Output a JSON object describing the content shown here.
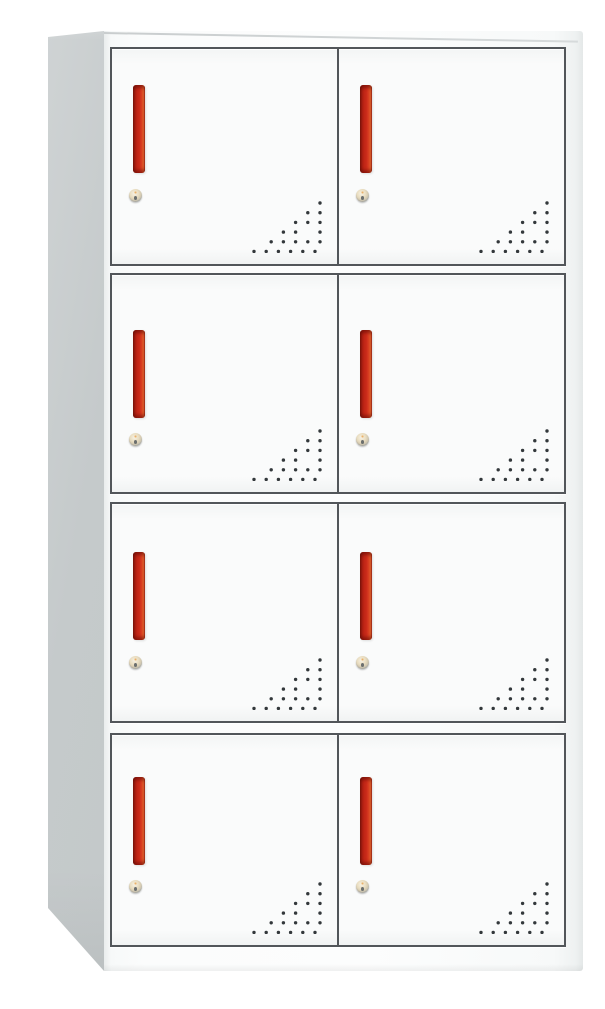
{
  "scene": {
    "type": "product-photo",
    "subject": "8-door metal locker storage cabinet",
    "description": "Front three-quarter view of a white steel office locker with four rows of two compartment doors; each door has a vertical red recessed handle, a round cam lock, and a triangular grid of ventilation holes in its lower-right corner.",
    "background_color": "#ffffff"
  },
  "cabinet": {
    "rows": 4,
    "columns": 2,
    "door_count": 8,
    "colors": {
      "body": "#fbfcfc",
      "side_panel": "#c5cacb",
      "door_border": "#52565a",
      "handle_main": "#c92a19",
      "handle_highlight": "#f06f35",
      "handle_shadow": "#8f1b10",
      "lock_face": "#e9ddc0",
      "lock_ring": "#a8acab",
      "vent_dot": "#33383b"
    },
    "vents": {
      "pattern": "right-triangle dot grid, aligned to lower-right corner",
      "rows": 6,
      "dot_radius": 1.7,
      "spacing_x": 12.2,
      "spacing_y": 9.7,
      "right_cx": 68,
      "top_cy": 6,
      "bottom_row_shift": -5,
      "crescent_row": 3,
      "crescent_index": 1,
      "accent": "one larger crescent-shaped punched hole"
    }
  },
  "doors": [
    {
      "id": "door-1",
      "row": 1,
      "column": "left",
      "features": "red handle, cam lock, vent holes"
    },
    {
      "id": "door-2",
      "row": 1,
      "column": "right",
      "features": "red handle, cam lock, vent holes"
    },
    {
      "id": "door-3",
      "row": 2,
      "column": "left",
      "features": "red handle, cam lock, vent holes"
    },
    {
      "id": "door-4",
      "row": 2,
      "column": "right",
      "features": "red handle, cam lock, vent holes"
    },
    {
      "id": "door-5",
      "row": 3,
      "column": "left",
      "features": "red handle, cam lock, vent holes"
    },
    {
      "id": "door-6",
      "row": 3,
      "column": "right",
      "features": "red handle, cam lock, vent holes"
    },
    {
      "id": "door-7",
      "row": 4,
      "column": "left",
      "features": "red handle, cam lock, vent holes"
    },
    {
      "id": "door-8",
      "row": 4,
      "column": "right",
      "features": "red handle, cam lock, vent holes"
    }
  ]
}
